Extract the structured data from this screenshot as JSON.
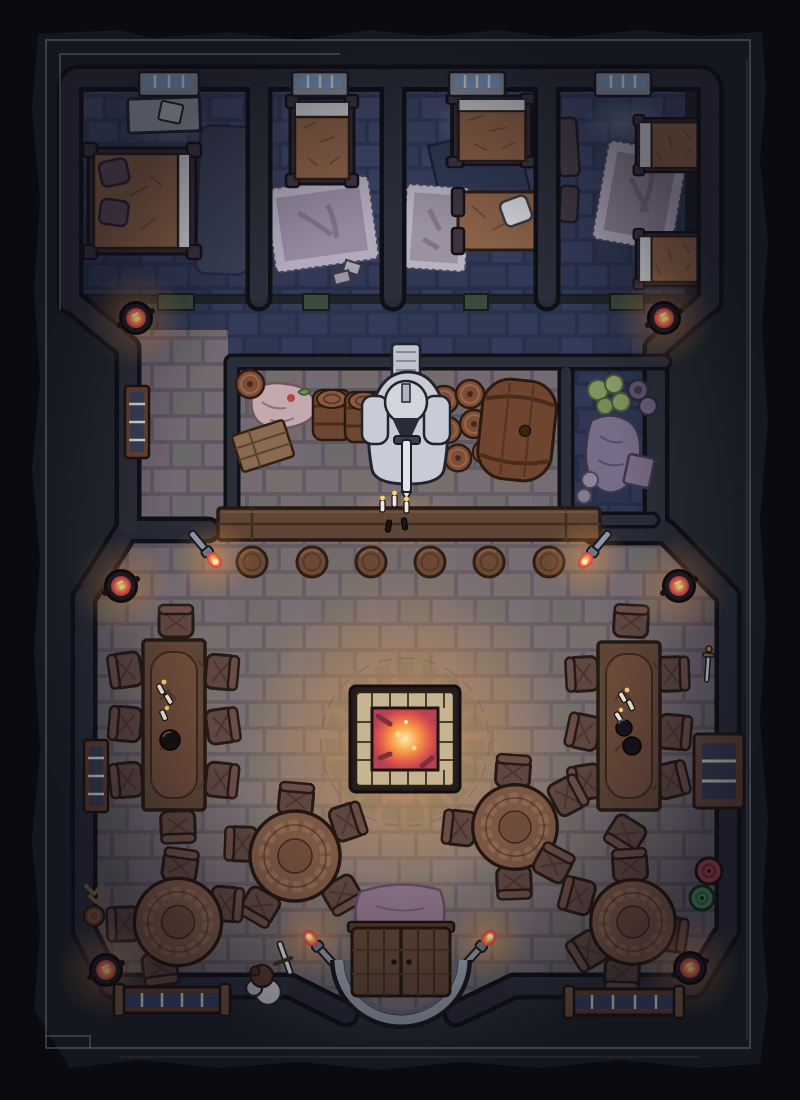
{
  "map": {
    "kind": "top-down fantasy battle map",
    "scene": "stone tavern / inn interior at night",
    "grid_visible": false,
    "lighting": "night, warm firelight in hall, cool moonlight in bedrooms"
  },
  "palette": {
    "page_bg": "#272e34",
    "torn_border": "#0a0b0e",
    "frame_line": "#9aa4a8",
    "wall_core": "#282a36",
    "wall_outline": "#0f1016",
    "bedroom_floor": "#404a6a",
    "hall_floor": "#7e7680",
    "pantry_floor": "#3d4259",
    "wood_dark": "#5f4536",
    "wood_outline": "#241a13",
    "chair": "#5f4640",
    "round_table": "#7b5744",
    "quilt": "#8c6247",
    "sheet": "#d5d6da",
    "rug_lilac": "#95899f",
    "rug_dark": "#3b4157",
    "window_glass": "#7fa6cf",
    "fire_core": "#ffe9a8",
    "fire_mid": "#f9a048",
    "fire_deep": "#b84350",
    "glow_orange": "#ff9a3c",
    "moonlight": "#cfe4ff",
    "statue_stone": "#c9ccd7",
    "pit_stone": "#c7b591",
    "shield_red": "#a84350",
    "shield_green": "#4f8f63",
    "sack_pink": "#c4a9ae",
    "cabbage_green": "#7e9460",
    "barrel_wood": "#7c4e38"
  },
  "inventory": {
    "bedrooms": [
      {
        "name": "bedroom-1",
        "furniture": [
          "double-bed",
          "desk",
          "dark-rug",
          "window",
          "door"
        ]
      },
      {
        "name": "bedroom-2",
        "furniture": [
          "single-bed",
          "light-rug",
          "window",
          "door"
        ]
      },
      {
        "name": "bedroom-3",
        "furniture": [
          "single-bed",
          "bedroll",
          "dark-blanket",
          "light-rug",
          "window",
          "door"
        ]
      },
      {
        "name": "bedroom-4",
        "furniture": [
          "single-bed",
          "single-bed",
          "light-rug",
          "bench",
          "window",
          "door"
        ]
      }
    ],
    "storeroom": [
      "sack-pile",
      "crate",
      "keg",
      "barrel",
      "barrel",
      "knight-statue",
      "keg-stack",
      "large-side-barrel"
    ],
    "pantry": [
      "cabbages",
      "pots",
      "large-sack",
      "bowls",
      "box"
    ],
    "bar": {
      "counter": 1,
      "stools": 6,
      "candles": 5
    },
    "main_hall": {
      "fire_pit": 1,
      "long_tables": 2,
      "round_tables": 4,
      "chairs": 35,
      "braziers": 6,
      "wall_torches": 4,
      "windows": 4,
      "entrance_double_door": 1,
      "door_rug": 1,
      "wall_decor": [
        "sword",
        "red-shield",
        "green-shield",
        "antler-trophy",
        "wall-drum"
      ],
      "figures": [
        "adventurer-with-sword"
      ]
    }
  }
}
